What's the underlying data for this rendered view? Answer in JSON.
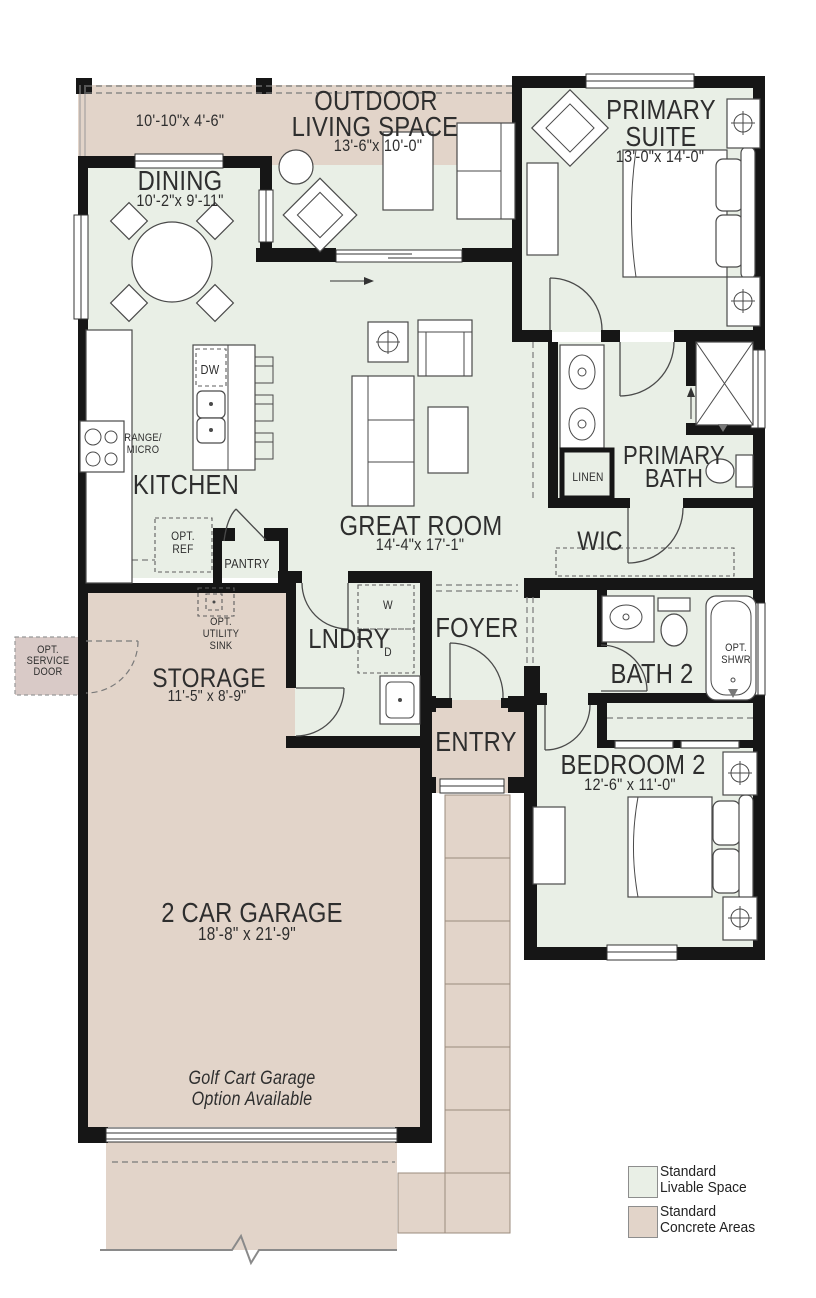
{
  "colors": {
    "livable": "#e9efe6",
    "concrete": "#e2d4c9",
    "optional": "#d9cac7",
    "wall": "#161616",
    "text": "#2e2e2e"
  },
  "rooms": {
    "patio": {
      "dims": "10'-10\"x 4'-6\""
    },
    "outdoor": {
      "line1": "OUTDOOR",
      "line2": "LIVING SPACE",
      "dims": "13'-6\"x 10'-0\""
    },
    "primary_suite": {
      "line1": "PRIMARY",
      "line2": "SUITE",
      "dims": "13'-0\"x 14'-0\""
    },
    "dining": {
      "name": "DINING",
      "dims": "10'-2\"x 9'-11\""
    },
    "kitchen": {
      "name": "KITCHEN"
    },
    "great_room": {
      "name": "GREAT ROOM",
      "dims": "14'-4\"x 17'-1\""
    },
    "primary_bath": {
      "line1": "PRIMARY",
      "line2": "BATH"
    },
    "linen": {
      "name": "LINEN"
    },
    "wic": {
      "name": "WIC"
    },
    "laundry": {
      "name": "LNDRY"
    },
    "foyer": {
      "name": "FOYER"
    },
    "entry": {
      "name": "ENTRY"
    },
    "bath2": {
      "name": "BATH 2"
    },
    "bedroom2": {
      "name": "BEDROOM 2",
      "dims": "12'-6\" x 11'-0\""
    },
    "storage": {
      "name": "STORAGE",
      "dims": "11'-5\" x 8'-9\""
    },
    "garage": {
      "name": "2 CAR GARAGE",
      "dims": "18'-8\" x 21'-9\"",
      "note_line1": "Golf Cart Garage",
      "note_line2": "Option Available"
    }
  },
  "fixtures": {
    "dw": "DW",
    "range_line1": "RANGE/",
    "range_line2": "MICRO",
    "opt_ref_line1": "OPT.",
    "opt_ref_line2": "REF",
    "pantry": "PANTRY",
    "washer": "W",
    "dryer": "D",
    "utility_line1": "OPT.",
    "utility_line2": "UTILITY",
    "utility_line3": "SINK",
    "service_line1": "OPT.",
    "service_line2": "SERVICE",
    "service_line3": "DOOR",
    "opt_shwr_line1": "OPT.",
    "opt_shwr_line2": "SHWR"
  },
  "legend": {
    "items": [
      {
        "label_line1": "Standard",
        "label_line2": "Livable Space",
        "swatch": "#e9efe6"
      },
      {
        "label_line1": "Standard",
        "label_line2": "Concrete Areas",
        "swatch": "#e2d4c9"
      }
    ]
  },
  "icons": {
    "plus_circle": "circle-with-cross lamp/outlet symbol on nightstands and side table",
    "shower_x": "crossed diagonals marking walk-in shower",
    "break_line": "zigzag break symbol at driveway edge"
  }
}
